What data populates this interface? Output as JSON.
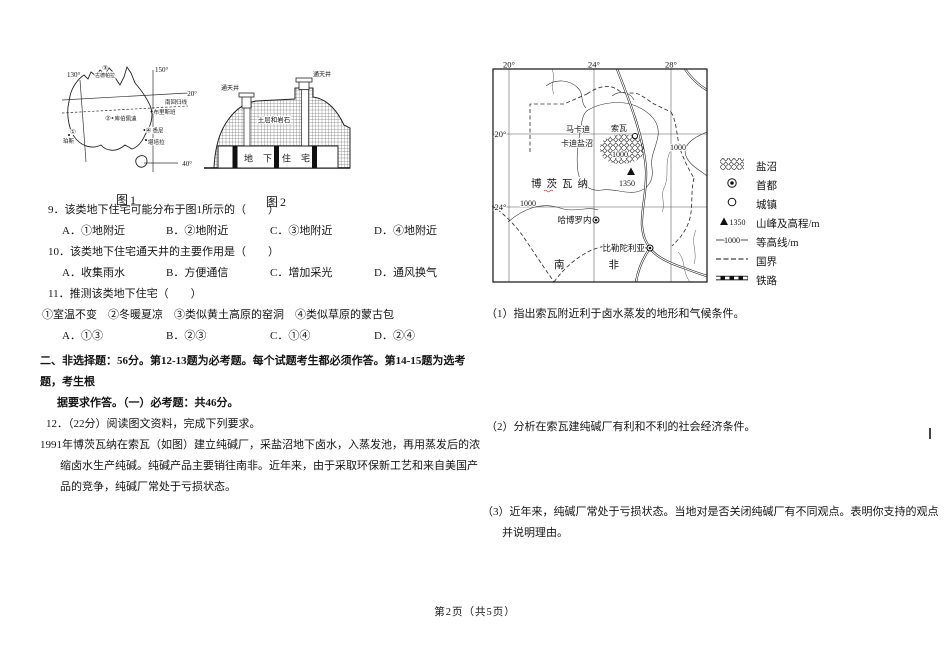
{
  "page": {
    "footer": "第2页（共5页）"
  },
  "fig1": {
    "caption": "图1",
    "lon130": "130°",
    "lon150": "150°",
    "lat20": "20°",
    "lat40": "40°",
    "tropic": "南回归线",
    "p3": "③",
    "p3_city": "古德帕拉",
    "p2": "②",
    "coober": "库伯佩迪",
    "p1": "①",
    "perth": "珀斯",
    "p4": "④",
    "sydney": "悉尼",
    "canberra": "堪培拉",
    "brisbane": "布里斯班"
  },
  "fig2": {
    "caption": "图2",
    "shaft_left": "通天井",
    "shaft_right": "通天井",
    "rock": "土层和岩石",
    "dwelling": "地下住宅"
  },
  "q9": {
    "stem": "9．该类地下住宅可能分布于图1所示的（　　）",
    "options": [
      "A．①地附近",
      "B．②地附近",
      "C．③地附近",
      "D．④地附近"
    ]
  },
  "q10": {
    "stem": "10．该类地下住宅通天井的主要作用是（　　）",
    "options": [
      "A．收集雨水",
      "B．方便通信",
      "C．增加采光",
      "D．通风换气"
    ]
  },
  "q11": {
    "stem": "11．推测该类地下住宅（　　）",
    "sub": "①室温不变　②冬暖夏凉　③类似黄土高原的窑洞　④类似草原的蒙古包",
    "options": [
      "A．①③",
      "B．②③",
      "C．①④",
      "D．②④"
    ]
  },
  "section2": {
    "heading_line1": "二、非选择题：56分。第12-13题为必考题。每个试题考生都必须作答。第14-15题为选考题，考生根",
    "heading_line2": "据要求作答。（一）必考题：共46分。",
    "q12_lead": "12．（22分）阅读图文资料，完成下列要求。",
    "q12_text": "1991年博茨瓦纳在索瓦（如图）建立纯碱厂，采盐沼地下卤水，入蒸发池，再用蒸发后的浓缩卤水生产纯碱。纯碱产品主要销往南非。近年来，由于采取环保新工艺和来自美国产品的竞争，纯碱厂常处于亏损状态。"
  },
  "map": {
    "top_lons": [
      "20°",
      "24°",
      "28°"
    ],
    "left_lats": [
      "20°",
      "24°"
    ],
    "saltpan_line1": "马卡迪",
    "saltpan_line2": "卡迪盐沼",
    "sowa": "索瓦",
    "country": "博茨瓦纳",
    "peak_elev": "1350",
    "contour_a": "1000",
    "contour_b": "1000",
    "contour_c": "1000",
    "gaborone": "哈博罗内",
    "pretoria": "比勒陀利亚",
    "south_africa": "南非"
  },
  "legend": {
    "items": [
      {
        "label": "盐沼"
      },
      {
        "label": "首都"
      },
      {
        "label": "城镇"
      },
      {
        "label": "山峰及高程/m",
        "value": "1350"
      },
      {
        "label": "等高线/m",
        "value": "1000"
      },
      {
        "label": "国界"
      },
      {
        "label": "铁路"
      }
    ]
  },
  "sub_questions": {
    "q1": "（1）指出索瓦附近利于卤水蒸发的地形和气候条件。",
    "q2": "（2）分析在索瓦建纯碱厂有利和不利的社会经济条件。",
    "q3": "（3）近年来，纯碱厂常处于亏损状态。当地对是否关闭纯碱厂有不同观点。表明你支持的观点并说明理由。"
  }
}
